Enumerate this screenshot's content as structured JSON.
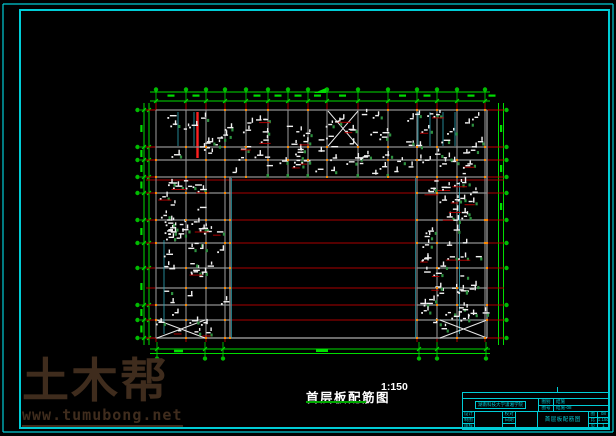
{
  "window": {
    "width": 616,
    "height": 436,
    "background": "#000000"
  },
  "colors": {
    "frame_cyan": "#00ccd6",
    "dim_green": "#00dd00",
    "bubble_green": "#00bb00",
    "grid_red": "#c00000",
    "courtyard_red": "#aa0000",
    "accent_red": "#ff2020",
    "beam_gray": "#909090",
    "slab_cyan": "#2fa8b8",
    "annotation_white": "#f2f2f2",
    "rebar_green": "#2e9240",
    "node_orange": "#ff8a00",
    "watermark_brown": "#3f2c1d",
    "title_white": "#ffffff",
    "underline_green": "#00a800",
    "xbrace_white": "#e8e8e8"
  },
  "drawing_title": {
    "text": "首层板配筋图",
    "scale": "1:150"
  },
  "watermark": {
    "brand": "土木帮",
    "url": "www.tumubong.net"
  },
  "title_block": {
    "organization": "湖南科技大学潇湘学院",
    "doc_class_label": "图别",
    "doc_no_label": "图号",
    "doc_class_value": "结施",
    "doc_no_value": "结施-08",
    "row_labels": [
      "设计",
      "制图",
      "审核"
    ],
    "row_labels2": [
      "校对",
      "日期"
    ],
    "drawing_name": "首层板配筋图",
    "mini_table": [
      [
        "图",
        "08"
      ],
      [
        "比",
        "1:150"
      ],
      [
        "页",
        "1"
      ]
    ]
  }
}
